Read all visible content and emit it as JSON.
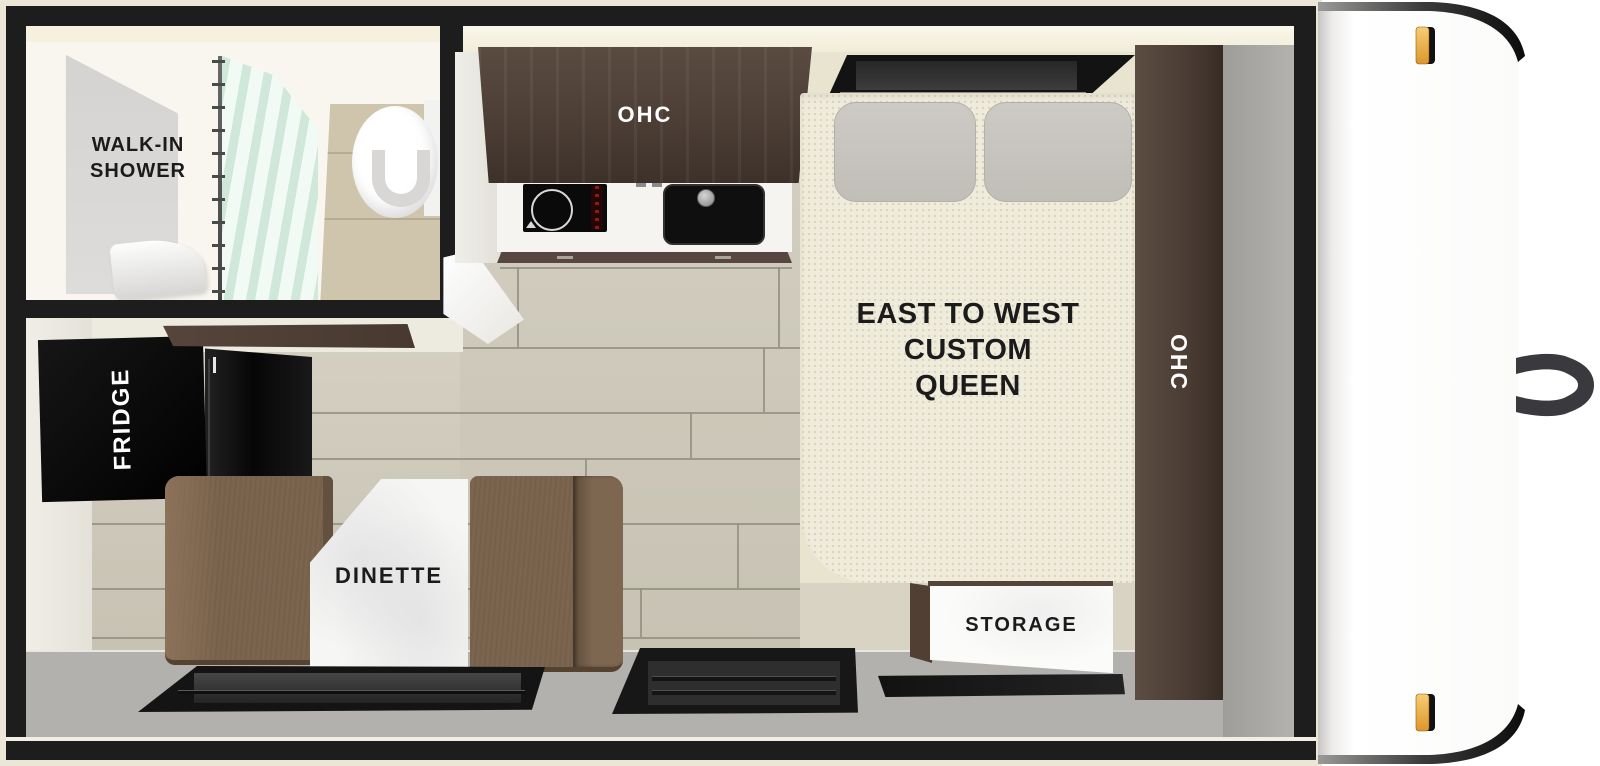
{
  "floorplan": {
    "type": "travel trailer floor plan",
    "labels": {
      "shower_line1": "WALK-IN",
      "shower_line2": "SHOWER",
      "kitchen_ohc": "OHC",
      "bed_line1": "EAST TO WEST",
      "bed_line2": "CUSTOM",
      "bed_line3": "QUEEN",
      "side_ohc": "OHC",
      "fridge": "FRIDGE",
      "dinette": "DINETTE",
      "storage": "STORAGE"
    },
    "palette": {
      "wall_black": "#1d1d1d",
      "trim_cream": "#ece6d6",
      "floor_wood": "#cfcaba",
      "bath_floor_wood": "#cfc5ad",
      "cabinet_wood_dark": "#4c3e35",
      "counter_white": "#f5f4f0",
      "mattress_cream": "#f0ecdc",
      "pillow_gray": "#c9c5bf",
      "bench_brown": "#7c654f",
      "table_white": "#f6f6f4",
      "rear_wall_gray": "#b2b1ad",
      "curtain_mint": "#dcefe6",
      "marker_light_amber": "#e8a838",
      "cap_white": "#ffffff"
    }
  }
}
